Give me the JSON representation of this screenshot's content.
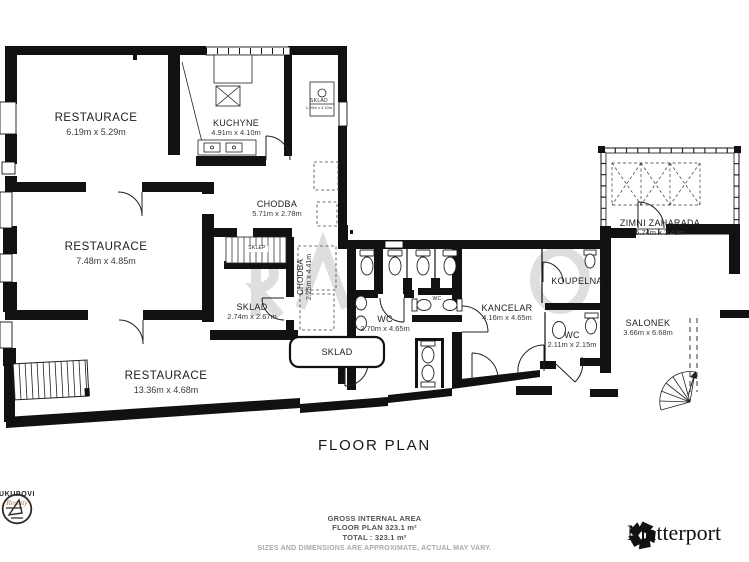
{
  "title": "FLOOR PLAN",
  "rooms": [
    {
      "name": "RESTAURACE",
      "dims": "6.19m x 5.29m"
    },
    {
      "name": "KUCHYNE",
      "dims": "4.91m x 4.10m"
    },
    {
      "name": "SKLAD",
      "dims": "1.99m x 4.10m"
    },
    {
      "name": "CHODBA",
      "dims": "5.71m x 2.78m"
    },
    {
      "name": "RESTAURACE",
      "dims": "7.48m x 4.85m"
    },
    {
      "name": "SKLEP",
      "dims": ""
    },
    {
      "name": "CHODBA",
      "dims": "2.25m x 4.41m"
    },
    {
      "name": "SKLAD",
      "dims": "2.74m x 2.67m"
    },
    {
      "name": "WC",
      "dims": "2.70m x 4.65m"
    },
    {
      "name": "WC",
      "dims": ""
    },
    {
      "name": "KANCELAR",
      "dims": "4.16m x 4.65m"
    },
    {
      "name": "KOUPELNA",
      "dims": ""
    },
    {
      "name": "WC",
      "dims": "2.11m x 2.15m"
    },
    {
      "name": "ZIMNI ZAHARADA",
      "dims": "5.74m x 3.43m"
    },
    {
      "name": "SALONEK",
      "dims": "3.66m x 6.68m"
    },
    {
      "name": "SKLAD",
      "dims": ""
    },
    {
      "name": "RESTAURACE",
      "dims": "13.36m x 4.68m"
    }
  ],
  "footer": {
    "line1": "GROSS INTERNAL AREA",
    "line2": "FLOOR PLAN 323.1 m²",
    "line3": "TOTAL :  323.1 m²",
    "disclaimer": "SIZES AND DIMENSIONS ARE APPROXIMATE, ACTUAL MAY VARY."
  },
  "branding": {
    "matterport": "Matterport",
    "agency_name": "UKUPOVI",
    "agency_sub": "Reality"
  }
}
